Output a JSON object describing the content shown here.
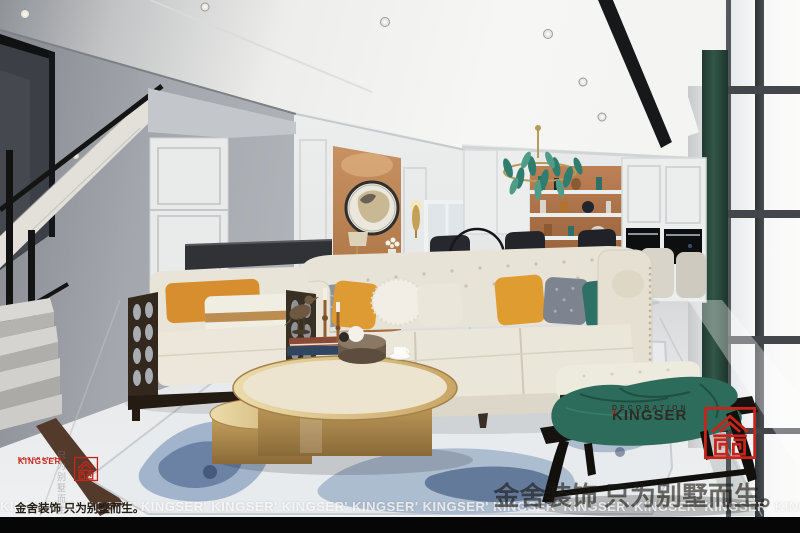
{
  "palette": {
    "brand_red": "#c8241b",
    "accent_orange": "#bb7c4b",
    "pillow_mustard": "#de9b33",
    "pillow_teal": "#2e6f66",
    "curtain_green": "#2c4a3d",
    "table_gold": "#c9a668",
    "wall_gray": "#a3a7ad",
    "sofa_cream": "#e8e3d7"
  },
  "watermarks": {
    "logo_small": {
      "brand": "KINGSER'",
      "sub": "DECORATION"
    },
    "logo_large": {
      "brand": "KINGSER",
      "apostrophe": "'",
      "sub": "DECORATION"
    },
    "slogan_left": "金舍装饰 只为别墅而生。",
    "slogan_large": "金舍装饰 只为别墅而生。",
    "vertical_note": "只为别墅而生",
    "ticker": "KINGSER' KINGSER' KINGSER' KINGSER' KINGSER' KINGSER' KINGSER' KINGSER' KINGSER' KINGSER' KINGSER' KINGSER' KINGSER' KINGSER'"
  }
}
